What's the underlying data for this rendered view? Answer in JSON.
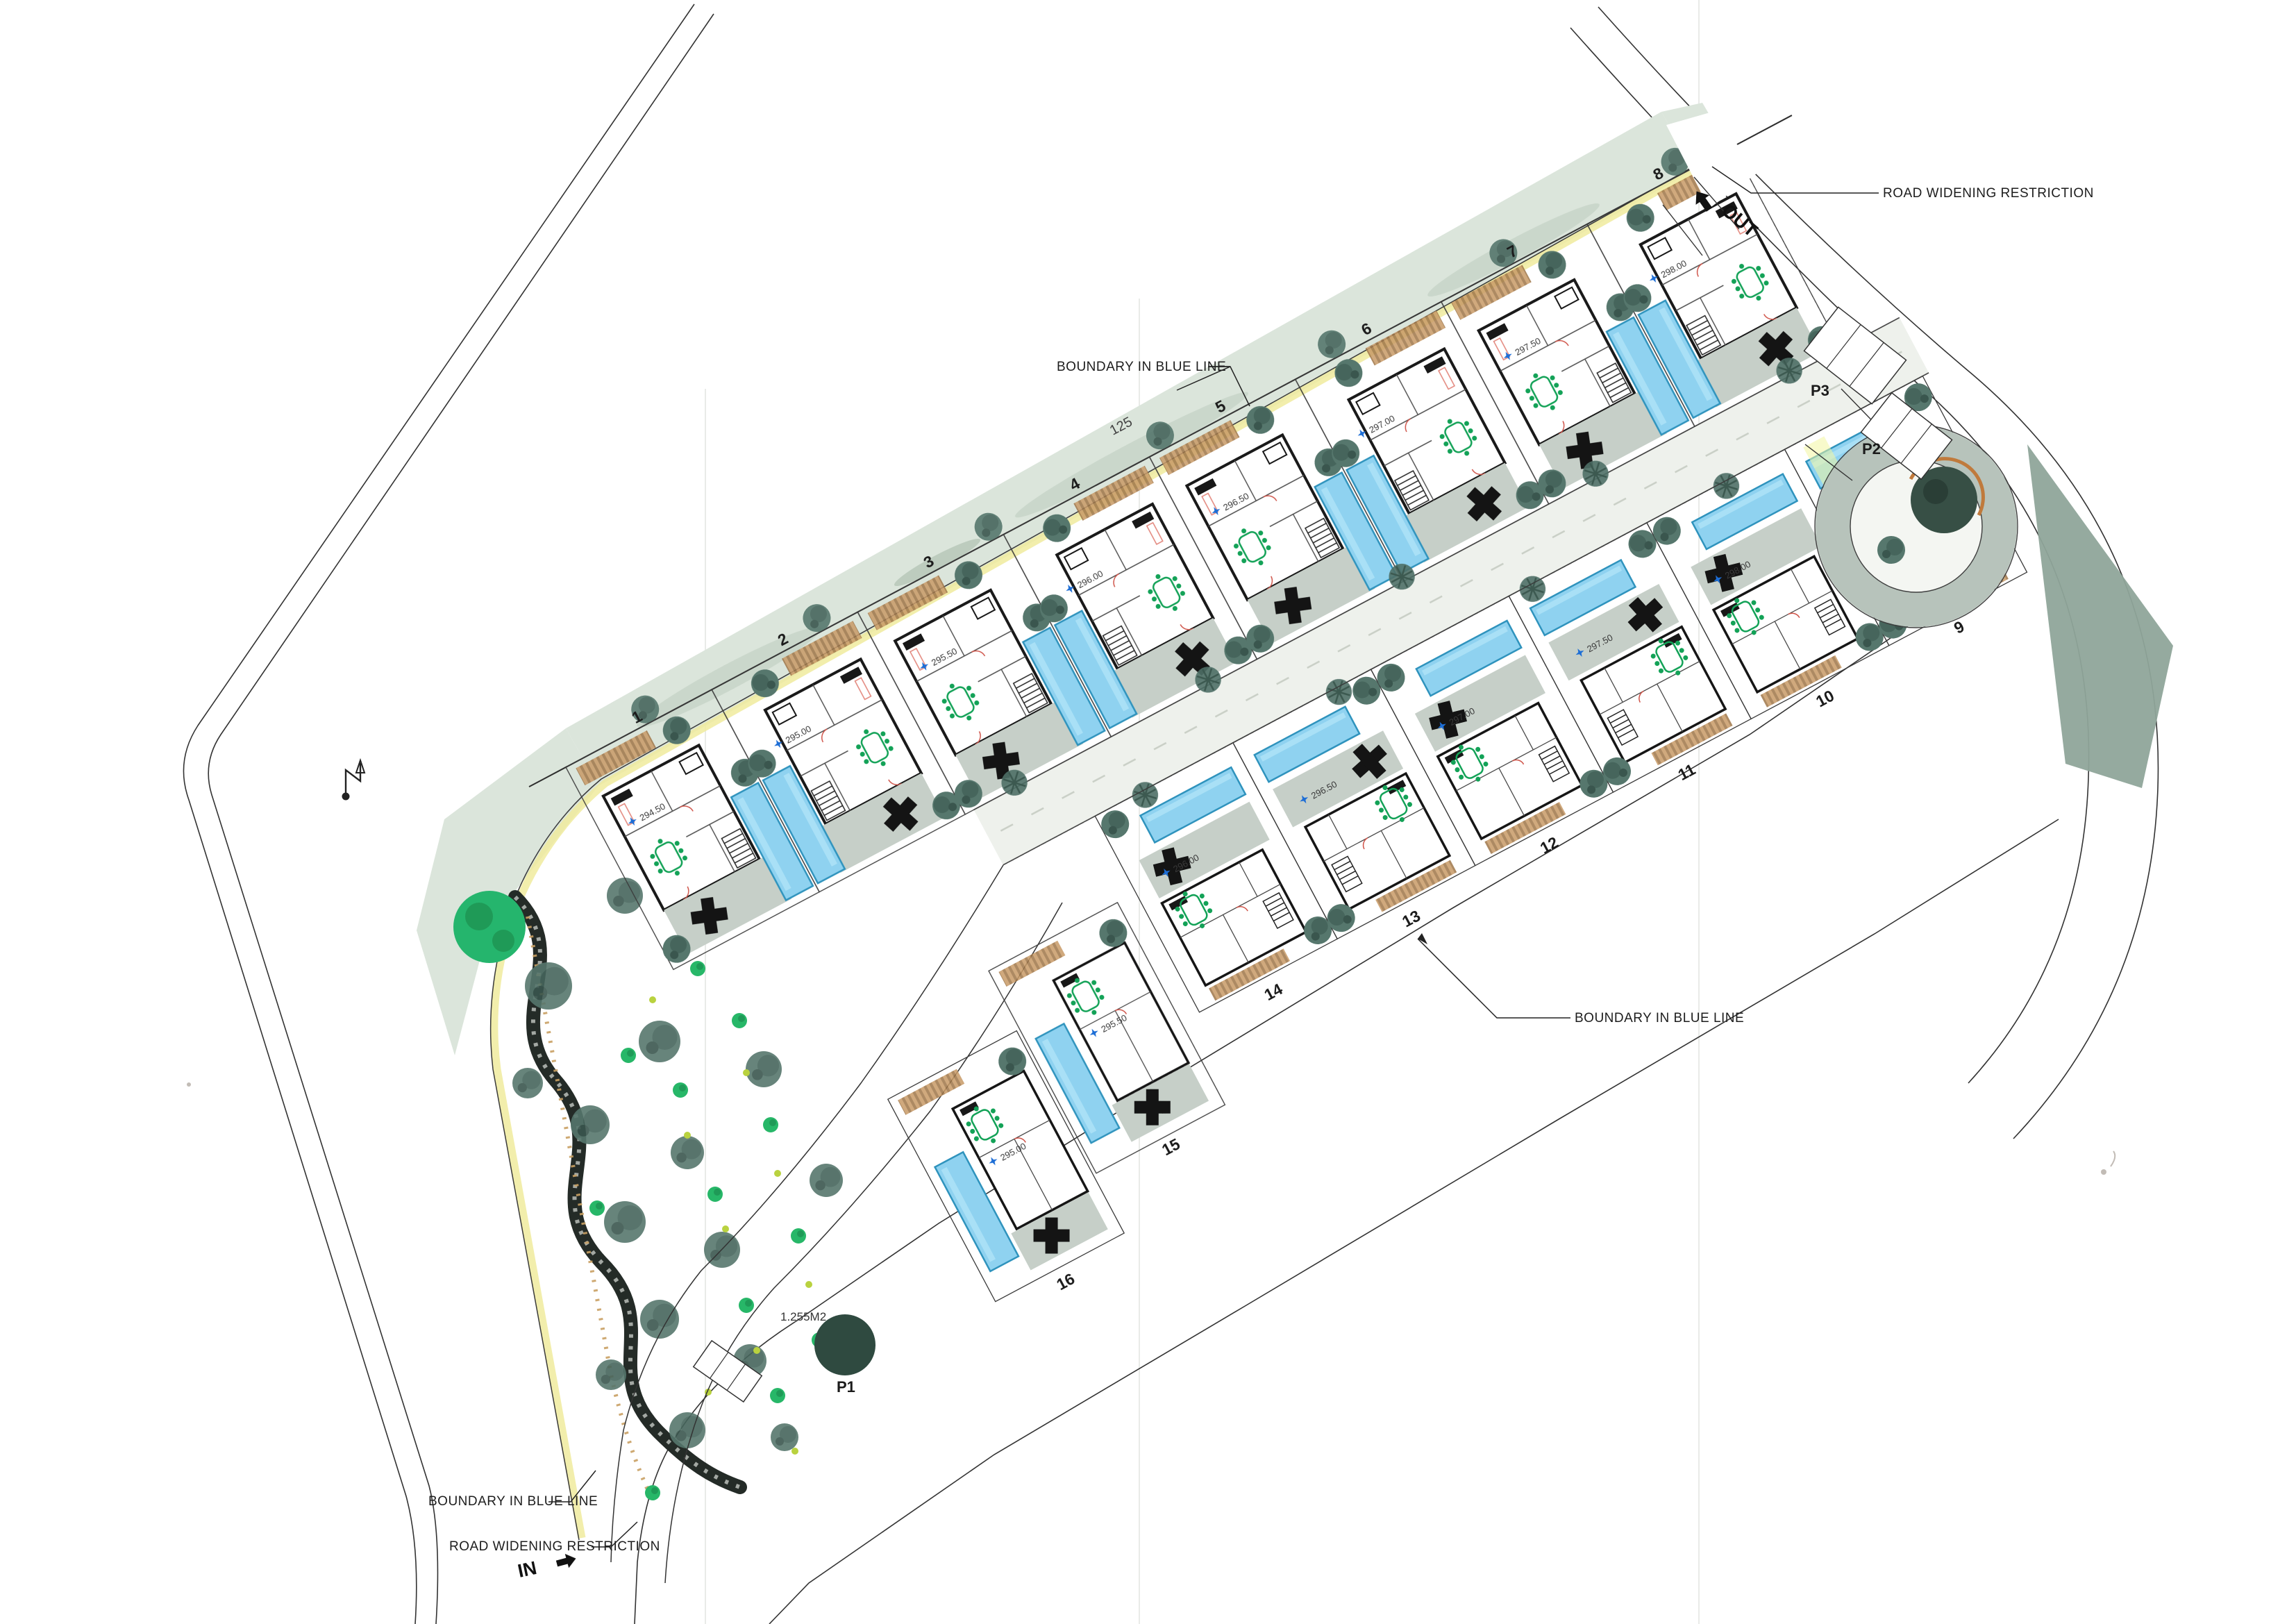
{
  "drawing": {
    "type": "architectural-site-plan",
    "labels": {
      "boundary_blue": "BOUNDARY IN BLUE LINE",
      "road_widening": "ROAD WIDENING RESTRICTION",
      "in": "IN",
      "out": "OUT",
      "garden_area": "1.255M2",
      "dim_top": "125",
      "p1": "P1",
      "p2": "P2",
      "p3": "P3"
    },
    "plots": {
      "upper": [
        {
          "number": "1",
          "level": "294.50"
        },
        {
          "number": "2",
          "level": "295.00"
        },
        {
          "number": "3",
          "level": "295.50"
        },
        {
          "number": "4",
          "level": "296.00"
        },
        {
          "number": "5",
          "level": "296.50"
        },
        {
          "number": "6",
          "level": "297.00"
        },
        {
          "number": "7",
          "level": "297.50"
        },
        {
          "number": "8",
          "level": "298.00"
        }
      ],
      "lower": [
        {
          "number": "14",
          "level": "296.00"
        },
        {
          "number": "13",
          "level": "296.50"
        },
        {
          "number": "12",
          "level": "297.00"
        },
        {
          "number": "11",
          "level": "297.50"
        },
        {
          "number": "10",
          "level": "298.00"
        },
        {
          "number": "9",
          "level": "298.50"
        }
      ],
      "cluster": [
        {
          "number": "15",
          "level": "295.50"
        },
        {
          "number": "16",
          "level": "295.00"
        }
      ]
    },
    "colors": {
      "pool": "#8fd2f0",
      "pool_border": "#2f93bd",
      "tree": "#53746a",
      "garden_green": "#27b768",
      "scan_band": "#dbe5db",
      "terrace": "#c6cfc8",
      "pergola": "#b5895c",
      "road_grey": "#b7c3bb",
      "line": "#2b2b2b",
      "level_star": "#1d6ed6",
      "yellow_edge": "#f0eb9e"
    }
  }
}
